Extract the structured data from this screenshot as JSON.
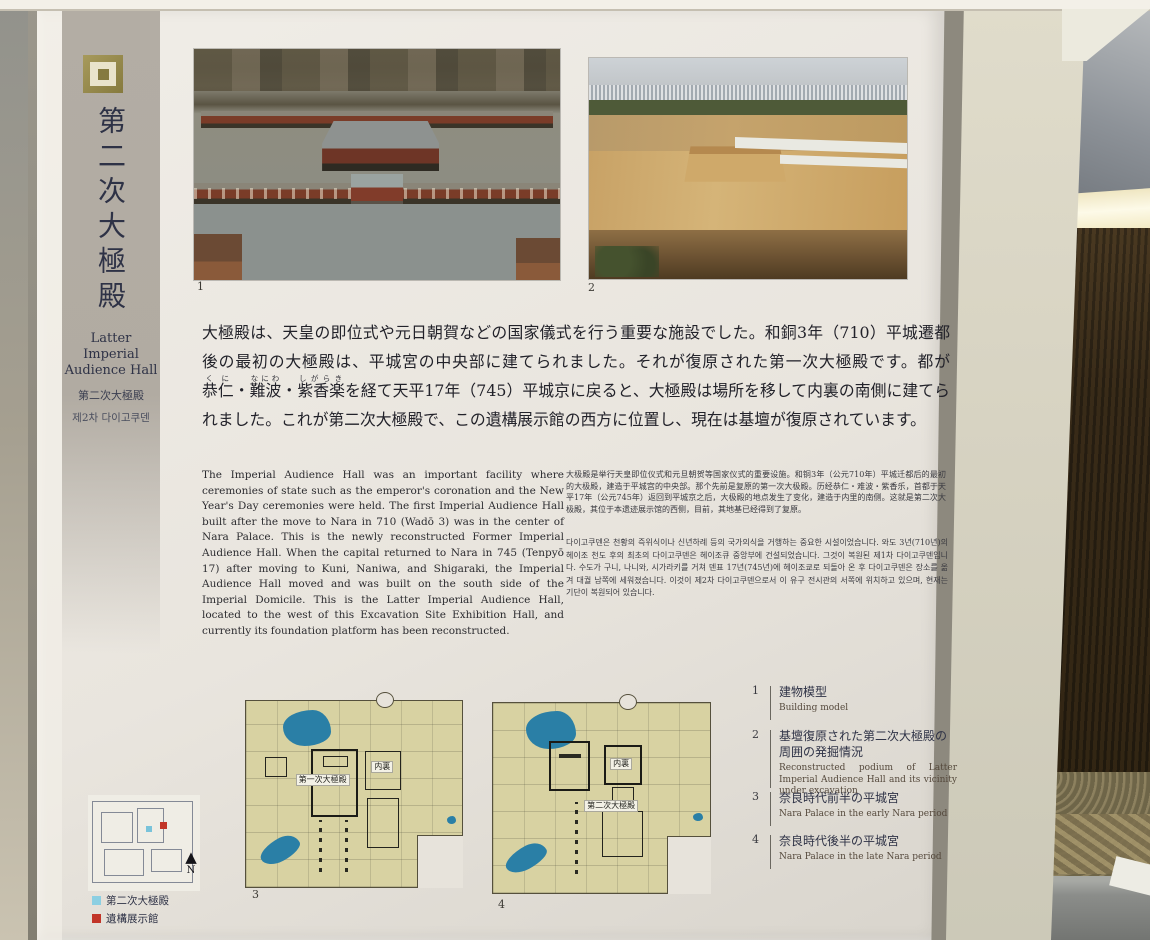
{
  "panel": {
    "icon": "nested-squares-mark-icon",
    "header": {
      "title_vertical": "第二次大極殿",
      "subtitle_en_1": "Latter Imperial",
      "subtitle_en_2": "Audience Hall",
      "subtitle_zh": "第二次大極殿",
      "subtitle_ko": "제2차 다이고쿠덴"
    },
    "photo_labels": {
      "photo1": "1",
      "photo2": "2"
    },
    "body_ja": {
      "p1": "大極殿は、天皇の即位式や元日朝賀などの国家儀式を行う重要な施設でした。和銅3年（710）平城遷都後の最初の大極殿は、平城宮の中央部に建てられました。それが復原された第一次大極殿です。都が",
      "name1": "恭仁",
      "name1_rt": "くに",
      "sep1": "・",
      "name2": "難波",
      "name2_rt": "なにわ",
      "sep2": "・",
      "name3": "紫香楽",
      "name3_rt": "しがらき",
      "p2": "を経て天平17年（745）平城京に戻ると、大極殿は場所を移して内裏の南側に建てられました。これが第二次大極殿で、この遺構展示館の西方に位置し、現在は基壇が復原されています。"
    },
    "body_en": "The Imperial Audience Hall was an important facility where ceremonies of state such as the emperor's coronation and the New Year's Day ceremonies were held. The first Imperial Audience Hall built after the move to Nara in 710 (Wadō 3) was in the center of Nara Palace. This is the newly reconstructed Former Imperial Audience Hall. When the capital returned to Nara in 745 (Tenpyō 17) after moving to Kuni, Naniwa, and Shigaraki, the Imperial Audience Hall moved and was built on the south side of the Imperial Domicile. This is the Latter Imperial Audience Hall, located to the west of this Excavation Site Exhibition Hall, and currently its foundation platform has been reconstructed.",
    "body_zh": "大极殿是举行天皇即位仪式和元旦朝贺等国家仪式的重要设施。和铜3年（公元710年）平城迁都后的最初的大极殿，建造于平城宫的中央部。那个先前是复原的第一次大极殿。历经恭仁・难波・紫香乐，首都于天平17年（公元745年）返回到平城京之后，大极殿的地点发生了变化，建造于内里的南侧。这就是第二次大极殿，其位于本遗迹展示馆的西侧，目前，其地基已经得到了复原。",
    "body_ko": "다이고쿠덴은 천황의 즉위식이나 신년하례 등의 국가의식을 거행하는 중요한 시설이었습니다. 와도 3년(710년)의 헤이조 천도 후의 최초의 다이고쿠덴은 헤이조큐 중앙부에 건설되었습니다. 그것이 복원된 제1차 다이고쿠덴입니다. 수도가 구니, 나니와, 시가라키를 거쳐 덴표 17년(745년)에 헤이조쿄로 되돌아 온 후 다이고쿠덴은 장소를 옮겨 대궐 남쪽에 세워졌습니다. 이것이 제2차 다이고쿠덴으로서 이 유구 전시관의 서쪽에 위치하고 있으며, 현재는 기단이 복원되어 있습니다.",
    "captions": {
      "items": [
        {
          "num": "1",
          "ja": "建物模型",
          "en": "Building model"
        },
        {
          "num": "2",
          "ja": "基壇復原された第二次大極殿の周囲の発掘情況",
          "en": "Reconstructed podium of Latter Imperial Audience Hall and its vicinity under excavation"
        },
        {
          "num": "3",
          "ja": "奈良時代前半の平城宮",
          "en": "Nara Palace in the early Nara period"
        },
        {
          "num": "4",
          "ja": "奈良時代後半の平城宮",
          "en": "Nara Palace in the late Nara period"
        }
      ]
    },
    "maps": {
      "map3": {
        "num": "3",
        "label_hall": "第一次大極殿",
        "label_dairi": "内裏"
      },
      "map4": {
        "num": "4",
        "label_hall": "第二次大極殿",
        "label_dairi": "内裏"
      },
      "locator": {
        "north": "N",
        "legend": [
          {
            "label": "第二次大極殿",
            "color": "#8ccfe2"
          },
          {
            "label": "遺構展示館",
            "color": "#c23528"
          }
        ]
      }
    },
    "colors": {
      "panel_bg": "#e9e5de",
      "band_grey": "#b3ada4",
      "title_ink": "#2e3246",
      "map_bg": "#d8d2a2",
      "pond_blue": "#2a7fa6",
      "legend_blue": "#8ccfe2",
      "legend_red": "#c23528"
    }
  }
}
